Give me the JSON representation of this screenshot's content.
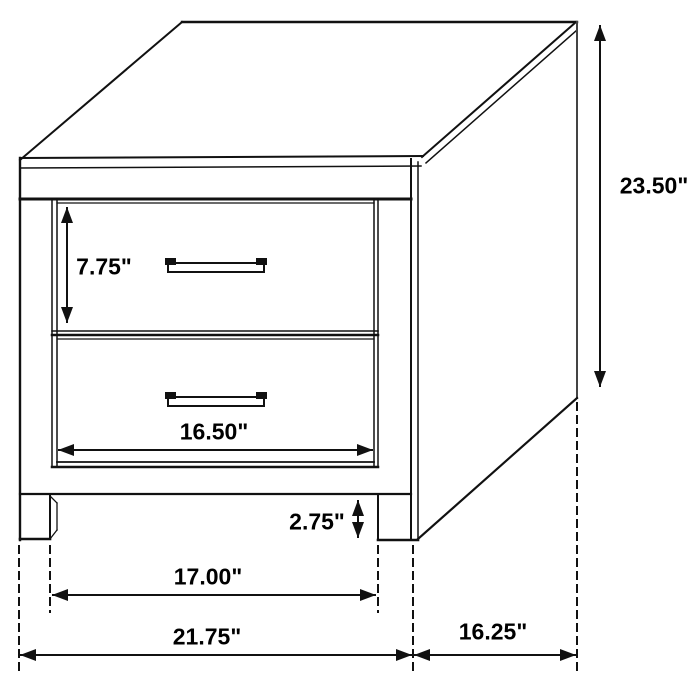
{
  "diagram": {
    "subject": "2-drawer nightstand dimension line drawing",
    "unit": "inches",
    "labels": {
      "drawer_front_height": "7.75\"",
      "overall_height": "23.50\"",
      "drawer_width": "16.50\"",
      "base_clearance_height": "2.75\"",
      "inner_leg_span": "17.00\"",
      "overall_width": "21.75\"",
      "overall_depth": "16.25\""
    },
    "colors": {
      "line": "#111111",
      "background": "#ffffff"
    }
  }
}
